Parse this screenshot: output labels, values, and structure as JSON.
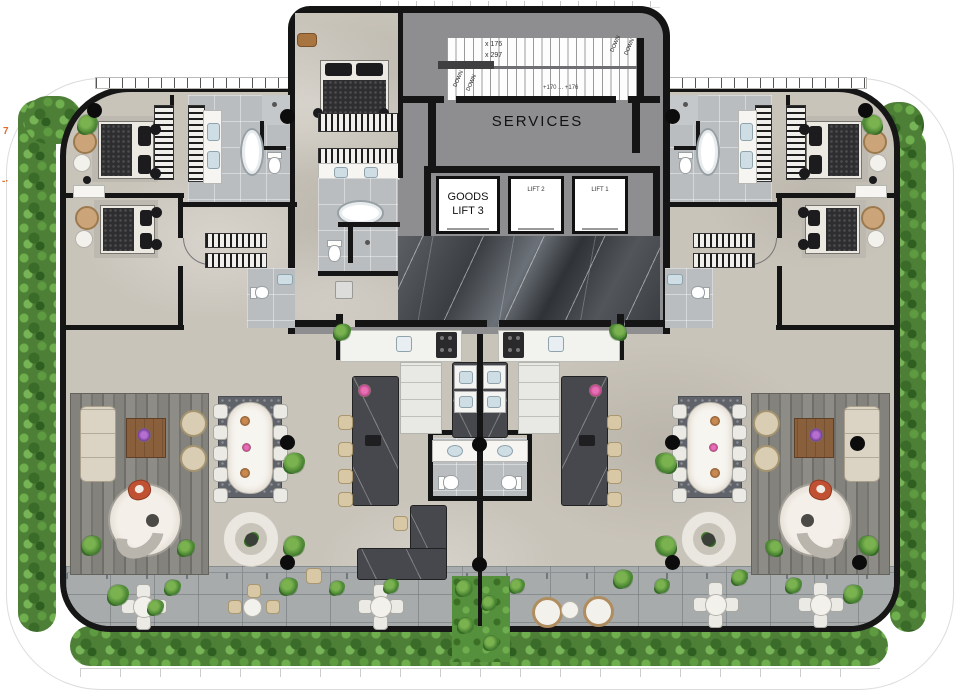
{
  "labels": {
    "services": "SERVICES",
    "goods_lift": "GOODS LIFT 3",
    "lift_2": "LIFT 2",
    "lift_1": "LIFT 1"
  },
  "stairs": {
    "note_1": "x 176",
    "note_2": "x 297",
    "level_note": "+170 ... +176",
    "down_labels": [
      "DOWN",
      "DOWN",
      "DOWN",
      "DOWN"
    ]
  },
  "margin_notes": {
    "left_1": "7",
    "left_2": "-·"
  },
  "colors": {
    "wall": "#151515",
    "floor": "#c9c4ba",
    "core_gray": "#8e8e90",
    "bath_tile": "#b9bdbf",
    "marble_dark": "#3b3e42",
    "hedge_green": "#4e7f37",
    "grass_green": "#55913c",
    "terrace_paving": "#a7abac",
    "accent_orange": "#e06a2d",
    "furniture_beige": "#d8c8a6",
    "island_stone": "#46484d"
  }
}
